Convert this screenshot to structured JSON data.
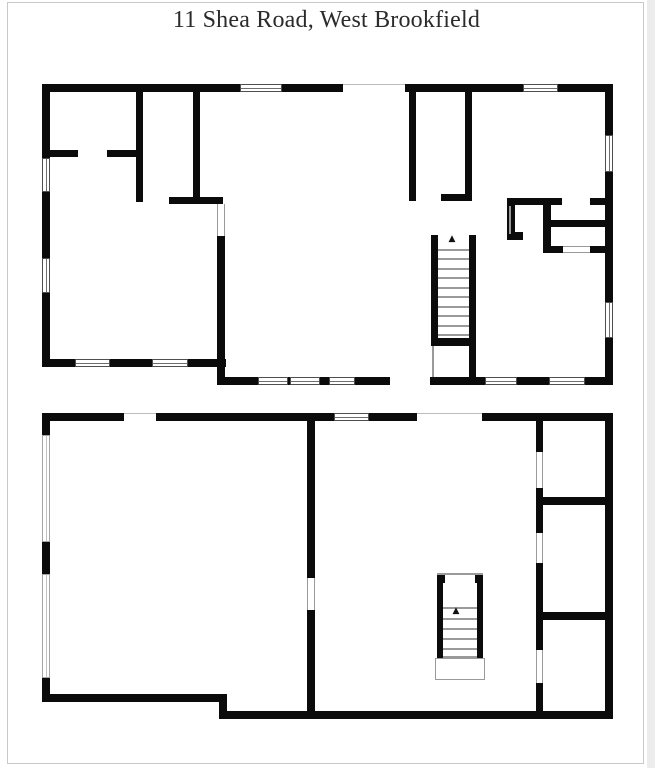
{
  "title": "11 Shea Road, West Brookfield",
  "icons": {
    "stairs_up_arrow": "▲"
  },
  "colors": {
    "wall": "#0b0b0b",
    "window_frame": "#4f4f4f",
    "door_frame": "#9a9a9a",
    "page_border": "#c9c9c9",
    "title_text": "#2b2b2b"
  },
  "floorplans": [
    {
      "name": "floorplan-upper",
      "walls": [
        [
          42,
          84,
          571,
          8
        ],
        [
          42,
          84,
          8,
          283
        ],
        [
          42,
          359,
          184,
          8
        ],
        [
          217,
          236,
          8,
          149
        ],
        [
          217,
          377,
          396,
          8
        ],
        [
          605,
          84,
          8,
          301
        ],
        [
          136,
          84,
          7,
          118
        ],
        [
          42,
          150,
          36,
          7
        ],
        [
          107,
          150,
          34,
          7
        ],
        [
          193,
          84,
          7,
          115
        ],
        [
          169,
          197,
          54,
          7
        ],
        [
          409,
          84,
          7,
          117
        ],
        [
          465,
          84,
          7,
          117
        ],
        [
          441,
          194,
          31,
          7
        ],
        [
          507,
          198,
          55,
          7
        ],
        [
          590,
          198,
          23,
          7
        ],
        [
          507,
          198,
          8,
          42
        ],
        [
          507,
          232,
          16,
          8
        ],
        [
          543,
          198,
          8,
          55
        ],
        [
          543,
          220,
          70,
          7
        ],
        [
          543,
          246,
          20,
          7
        ],
        [
          590,
          246,
          23,
          7
        ],
        [
          431,
          235,
          7,
          111
        ],
        [
          469,
          235,
          7,
          143
        ],
        [
          431,
          338,
          45,
          8
        ]
      ],
      "gaps": [
        {
          "r": [
            343,
            84,
            62,
            8
          ],
          "edge": "top"
        },
        {
          "r": [
            390,
            377,
            40,
            8
          ]
        }
      ],
      "windows": [
        {
          "r": [
            240,
            84,
            42,
            8
          ],
          "o": "h"
        },
        {
          "r": [
            523,
            84,
            35,
            8
          ],
          "o": "h"
        },
        {
          "r": [
            42,
            158,
            8,
            34
          ],
          "o": "v"
        },
        {
          "r": [
            42,
            258,
            8,
            35
          ],
          "o": "v"
        },
        {
          "r": [
            75,
            359,
            35,
            8
          ],
          "o": "h"
        },
        {
          "r": [
            152,
            359,
            36,
            8
          ],
          "o": "h"
        },
        {
          "r": [
            258,
            377,
            30,
            8
          ],
          "o": "h"
        },
        {
          "r": [
            290,
            377,
            30,
            8
          ],
          "o": "h"
        },
        {
          "r": [
            329,
            377,
            26,
            8
          ],
          "o": "h"
        },
        {
          "r": [
            485,
            377,
            32,
            8
          ],
          "o": "h"
        },
        {
          "r": [
            549,
            377,
            36,
            8
          ],
          "o": "h"
        },
        {
          "r": [
            605,
            135,
            8,
            37
          ],
          "o": "v"
        },
        {
          "r": [
            605,
            302,
            8,
            36
          ],
          "o": "v"
        }
      ],
      "doors": [
        {
          "r": [
            217,
            204,
            8,
            32
          ],
          "o": "v"
        },
        {
          "r": [
            563,
            246,
            27,
            7
          ],
          "o": "h"
        }
      ],
      "thinlines": [
        [
          438,
          249,
          31,
          1.5
        ],
        [
          438,
          258,
          31,
          1.5
        ],
        [
          438,
          268,
          31,
          1.5
        ],
        [
          438,
          277,
          31,
          1.5
        ],
        [
          438,
          287,
          31,
          1.5
        ],
        [
          438,
          296,
          31,
          1.5
        ],
        [
          438,
          306,
          31,
          1.5
        ],
        [
          438,
          315,
          31,
          1.5
        ],
        [
          438,
          325,
          31,
          1.5
        ],
        [
          438,
          334,
          31,
          1.5
        ],
        [
          432,
          346,
          1.5,
          31
        ],
        [
          509,
          206,
          1.5,
          28
        ]
      ],
      "outlines": [],
      "glyphs": [
        {
          "x": 446,
          "y": 235,
          "size": 9
        }
      ]
    },
    {
      "name": "floorplan-lower",
      "walls": [
        [
          42,
          413,
          571,
          8
        ],
        [
          42,
          413,
          8,
          289
        ],
        [
          42,
          694,
          185,
          8
        ],
        [
          219,
          694,
          8,
          25
        ],
        [
          219,
          711,
          394,
          8
        ],
        [
          605,
          413,
          8,
          306
        ],
        [
          307,
          413,
          8,
          165
        ],
        [
          307,
          610,
          8,
          109
        ],
        [
          536,
          421,
          7,
          31
        ],
        [
          536,
          488,
          7,
          45
        ],
        [
          536,
          563,
          7,
          87
        ],
        [
          536,
          683,
          7,
          32
        ],
        [
          540,
          497,
          73,
          8
        ],
        [
          540,
          612,
          73,
          8
        ],
        [
          437,
          573,
          8,
          10
        ],
        [
          475,
          573,
          8,
          10
        ],
        [
          437,
          578,
          6,
          80
        ],
        [
          477,
          578,
          6,
          80
        ]
      ],
      "gaps": [
        {
          "r": [
            124,
            413,
            32,
            8
          ],
          "edge": "top"
        },
        {
          "r": [
            417,
            413,
            65,
            8
          ],
          "edge": "top"
        }
      ],
      "windows": [
        {
          "r": [
            334,
            413,
            35,
            8
          ],
          "o": "h"
        },
        {
          "r": [
            42,
            435,
            8,
            107
          ],
          "o": "v",
          "light": true
        },
        {
          "r": [
            42,
            574,
            8,
            104
          ],
          "o": "v",
          "light": true
        }
      ],
      "doors": [
        {
          "r": [
            307,
            578,
            8,
            32
          ],
          "o": "v"
        },
        {
          "r": [
            536,
            452,
            7,
            36
          ],
          "o": "v"
        },
        {
          "r": [
            536,
            533,
            7,
            30
          ],
          "o": "v"
        },
        {
          "r": [
            536,
            650,
            7,
            33
          ],
          "o": "v"
        }
      ],
      "thinlines": [
        [
          437,
          573,
          46,
          1.5
        ],
        [
          443,
          607,
          34,
          1.5
        ],
        [
          443,
          618,
          34,
          1.5
        ],
        [
          443,
          628,
          34,
          1.5
        ],
        [
          443,
          638,
          34,
          1.5
        ],
        [
          443,
          648,
          34,
          1.5
        ],
        [
          443,
          656,
          34,
          1.5
        ],
        [
          437,
          668,
          46,
          1.5
        ]
      ],
      "outlines": [
        [
          435,
          658,
          50,
          22
        ]
      ],
      "glyphs": [
        {
          "x": 450,
          "y": 607,
          "size": 9
        }
      ]
    }
  ]
}
